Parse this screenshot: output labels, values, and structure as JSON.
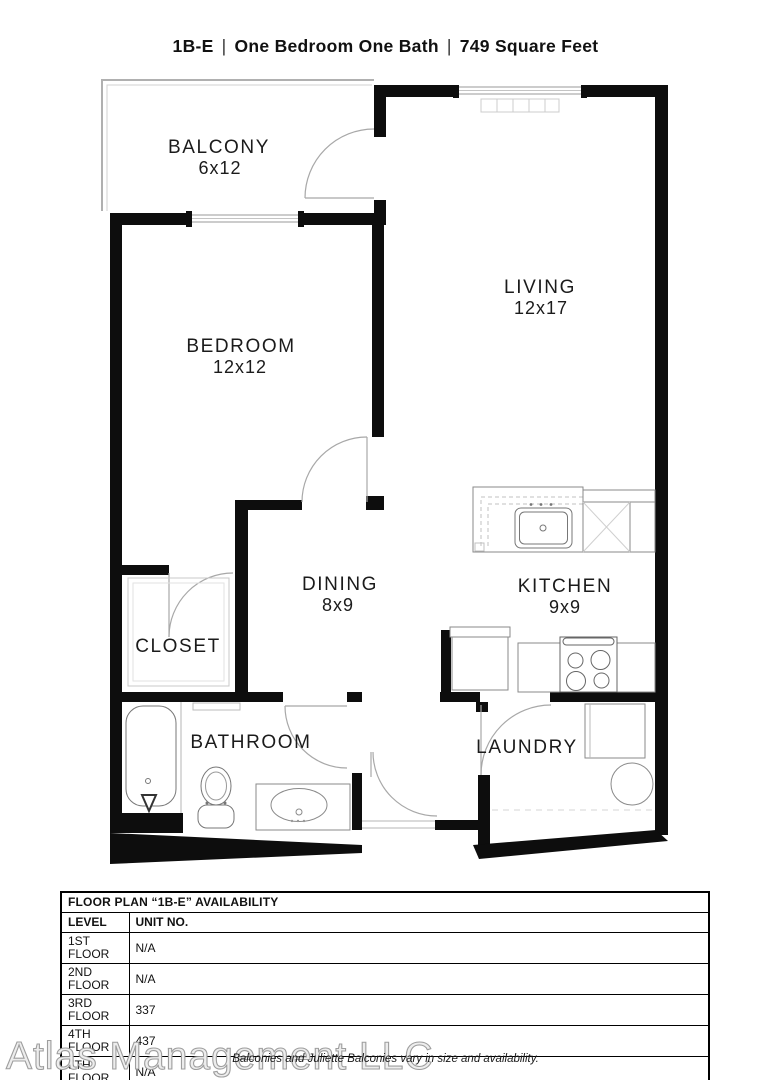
{
  "title": {
    "code": "1B-E",
    "separator": "|",
    "type": "One Bedroom One Bath",
    "area": "749 Square Feet"
  },
  "rooms": {
    "balcony": {
      "name": "BALCONY",
      "dim": "6x12"
    },
    "living": {
      "name": "LIVING",
      "dim": "12x17"
    },
    "bedroom": {
      "name": "BEDROOM",
      "dim": "12x12"
    },
    "dining": {
      "name": "DINING",
      "dim": "8x9"
    },
    "kitchen": {
      "name": "KITCHEN",
      "dim": "9x9"
    },
    "closet": {
      "name": "CLOSET"
    },
    "bathroom": {
      "name": "BATHROOM"
    },
    "laundry": {
      "name": "LAUNDRY"
    }
  },
  "availability_table": {
    "title": "FLOOR PLAN “1B-E” AVAILABILITY",
    "columns": [
      "LEVEL",
      "UNIT NO."
    ],
    "rows": [
      [
        "1ST FLOOR",
        "N/A"
      ],
      [
        "2ND FLOOR",
        "N/A"
      ],
      [
        "3RD FLOOR",
        "337"
      ],
      [
        "4TH FLOOR",
        "437"
      ],
      [
        "5TH FLOOR",
        "N/A"
      ],
      [
        "6TH FLOOR",
        "N/A"
      ]
    ]
  },
  "watermark": "Atlas Management LLC",
  "footnote": "Balconies and Juliette Balconies vary in size and availability.",
  "colors": {
    "wall": "#0d0d0d",
    "thin_line": "#9a9a9a",
    "door_arc": "#a8a8a8"
  }
}
